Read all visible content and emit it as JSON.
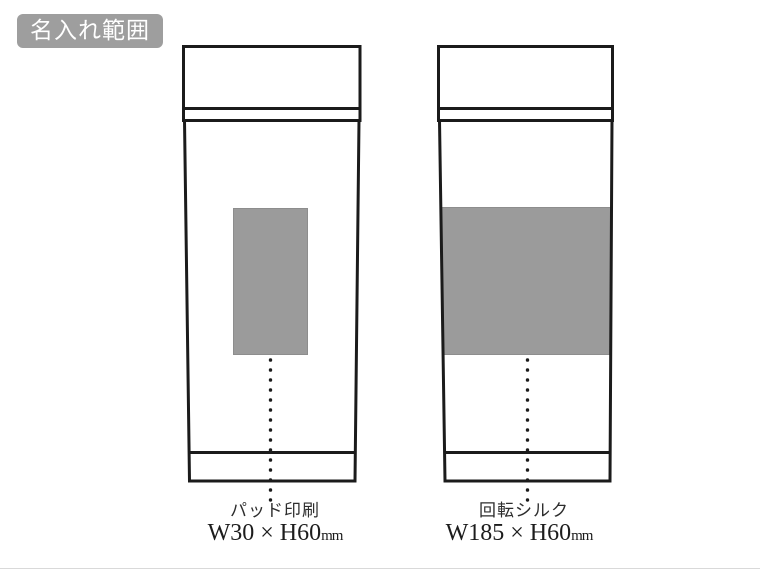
{
  "badge": {
    "label": "名入れ範囲"
  },
  "colors": {
    "outline": "#1b1b1b",
    "print_area_fill": "#9b9b9b",
    "print_area_border": "#8d8d8d",
    "badge_bg": "#9e9e9e",
    "badge_text": "#ffffff"
  },
  "tumblers": [
    {
      "position": "left",
      "method_label": "パッド印刷",
      "dimension_text": "W30 × H60",
      "dimension_unit": "mm"
    },
    {
      "position": "right",
      "method_label": "回転シルク",
      "dimension_text": "W185 × H60",
      "dimension_unit": "mm"
    }
  ]
}
